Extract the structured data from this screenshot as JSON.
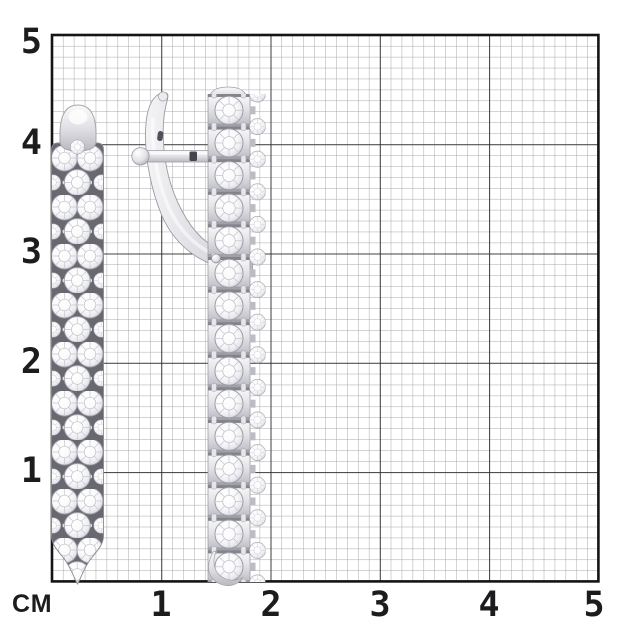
{
  "ruler": {
    "unit_label": "СМ",
    "x_labels": [
      "1",
      "2",
      "3",
      "4",
      "5"
    ],
    "y_labels": [
      "5",
      "4",
      "3",
      "2",
      "1"
    ]
  },
  "grid": {
    "unit": "cm",
    "cm_in_px": 109.28,
    "minor_divisions_per_cm": 10,
    "colors": {
      "background": "#ffffff",
      "minor_line": "#a8a8a8",
      "major_line": "#2c2c2c",
      "border": "#141414",
      "label": "#1c1c1e"
    }
  },
  "objects": [
    {
      "name": "diamond-earring-front-view",
      "approx_length_cm": 4.4
    },
    {
      "name": "diamond-earring-side-view",
      "approx_length_cm": 4.5
    }
  ]
}
